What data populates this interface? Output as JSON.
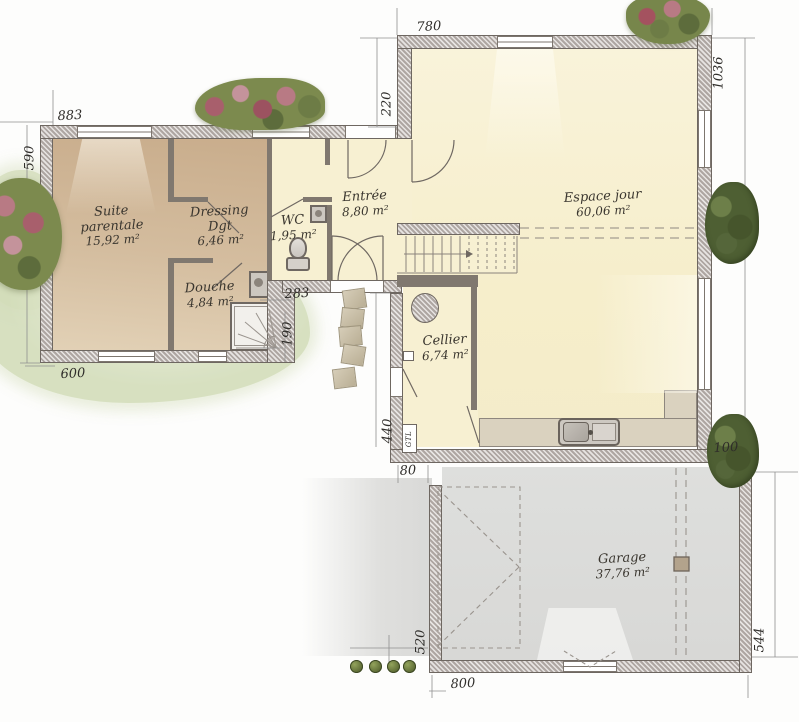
{
  "plan": {
    "title": "Plan de maison - rez-de-chaussée",
    "rooms": {
      "suite_parentale": {
        "name": "Suite parentale",
        "area": "15,92 m²"
      },
      "dressing": {
        "name": "Dressing Dgt",
        "area": "6,46 m²"
      },
      "douche": {
        "name": "Douche",
        "area": "4,84 m²"
      },
      "wc": {
        "name": "WC",
        "area": "1,95 m²"
      },
      "entree": {
        "name": "Entrée",
        "area": "8,80 m²"
      },
      "espace_jour": {
        "name": "Espace jour",
        "area": "60,06 m²"
      },
      "cellier": {
        "name": "Cellier",
        "area": "6,74 m²"
      },
      "garage": {
        "name": "Garage",
        "area": "37,76 m²"
      }
    },
    "labels": {
      "gtl": "GTL"
    },
    "dimensions_cm": {
      "left_wing_top": "883",
      "left_wing_side": "590",
      "left_wing_bottom": "600",
      "living_top": "780",
      "entry_inset": "220",
      "living_right": "1036",
      "porch_width": "283",
      "porch_depth": "190",
      "cellier_side": "440",
      "garage_gap": "80",
      "garage_offset": "100",
      "garage_left": "520",
      "garage_bottom": "800",
      "garage_right": "544"
    },
    "colors": {
      "living_floor": "#f7f0d2",
      "bedroom_floor": "#d2b998",
      "garage_floor": "#dcdcda",
      "wall_fill": "#cac3bf",
      "counter": "#dad2bf",
      "grass": "#d3ddba",
      "bush_green": "#4e5f33",
      "bush_pink": "#b07079"
    }
  }
}
